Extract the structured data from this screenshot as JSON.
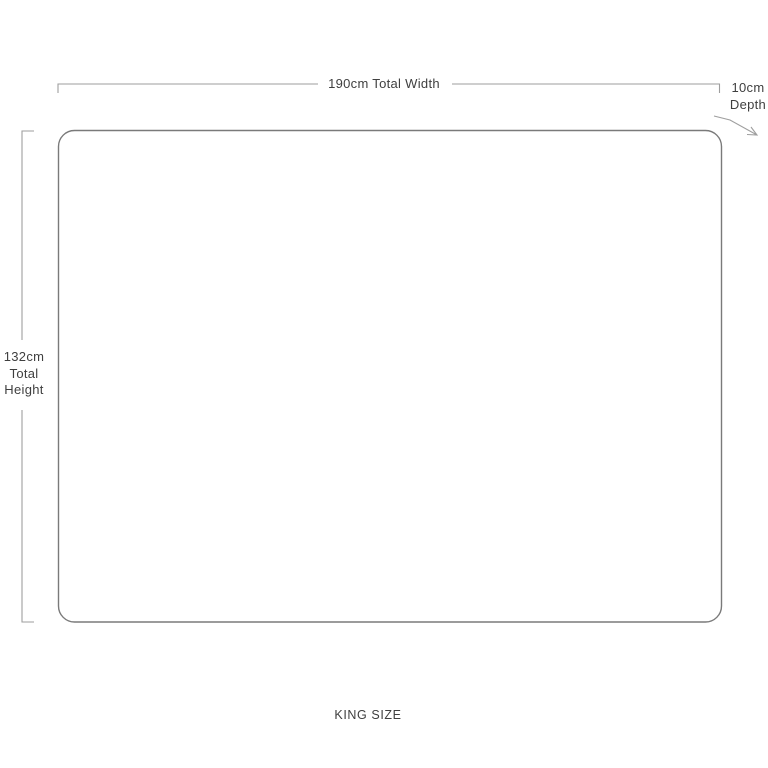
{
  "diagram": {
    "title": "KING SIZE headboard dimension diagram",
    "width_label": "190cm Total Width",
    "depth_label": {
      "line1": "10cm",
      "line2": "Depth"
    },
    "height_label": {
      "line1": "132cm",
      "line2": "Total",
      "line3": "Height"
    },
    "size_label": "KING SIZE",
    "dimensions": {
      "total_width_cm": 190,
      "total_height_cm": 132,
      "depth_cm": 10
    }
  },
  "colors": {
    "background": "#ffffff",
    "outline": "#7a7a7a",
    "dimension_line": "#9e9e9e",
    "text": "#3f3f3f"
  }
}
